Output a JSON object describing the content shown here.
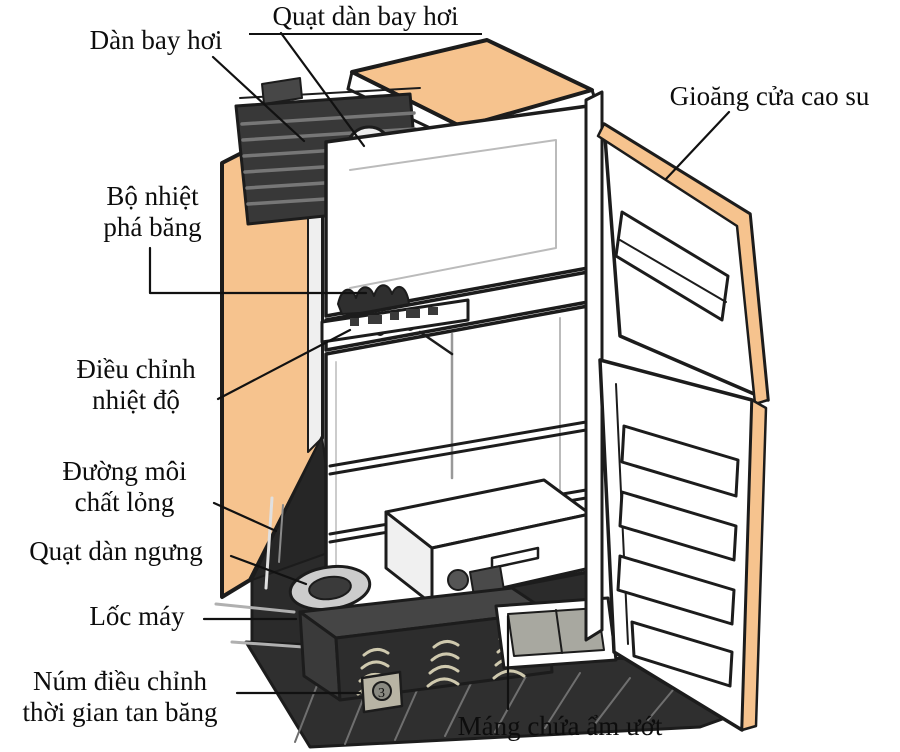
{
  "diagram": {
    "subject": "refrigerator-cutaway-diagram",
    "background": "#FFFFFF",
    "colors": {
      "panel_peach": "#F6C38E",
      "outline_ink": "#1C1C1C",
      "dark_component": "#2F2F2F",
      "tray_gray": "#A8A8A0"
    },
    "labels": {
      "quat_dan_bay_hoi": "Quạt dàn bay hơi",
      "dan_bay_hoi": "Dàn bay hơi",
      "gioang_cua_cao_su": "Gioăng cửa cao su",
      "bo_nhiet_line1": "Bộ nhiệt",
      "bo_nhiet_line2": "phá băng",
      "dieu_chinh_line1": "Điều chỉnh",
      "dieu_chinh_line2": "nhiệt độ",
      "duong_moi_line1": "Đường môi",
      "duong_moi_line2": "chất lỏng",
      "quat_dan_ngung": "Quạt dàn ngưng",
      "loc_may": "Lốc máy",
      "num_dieu_chinh_line1": "Núm điều chỉnh",
      "num_dieu_chinh_line2": "thời gian tan băng",
      "mang_chua_am_uot": "Máng chứa ẩm ướt",
      "timer_knob_mark": "3"
    }
  }
}
